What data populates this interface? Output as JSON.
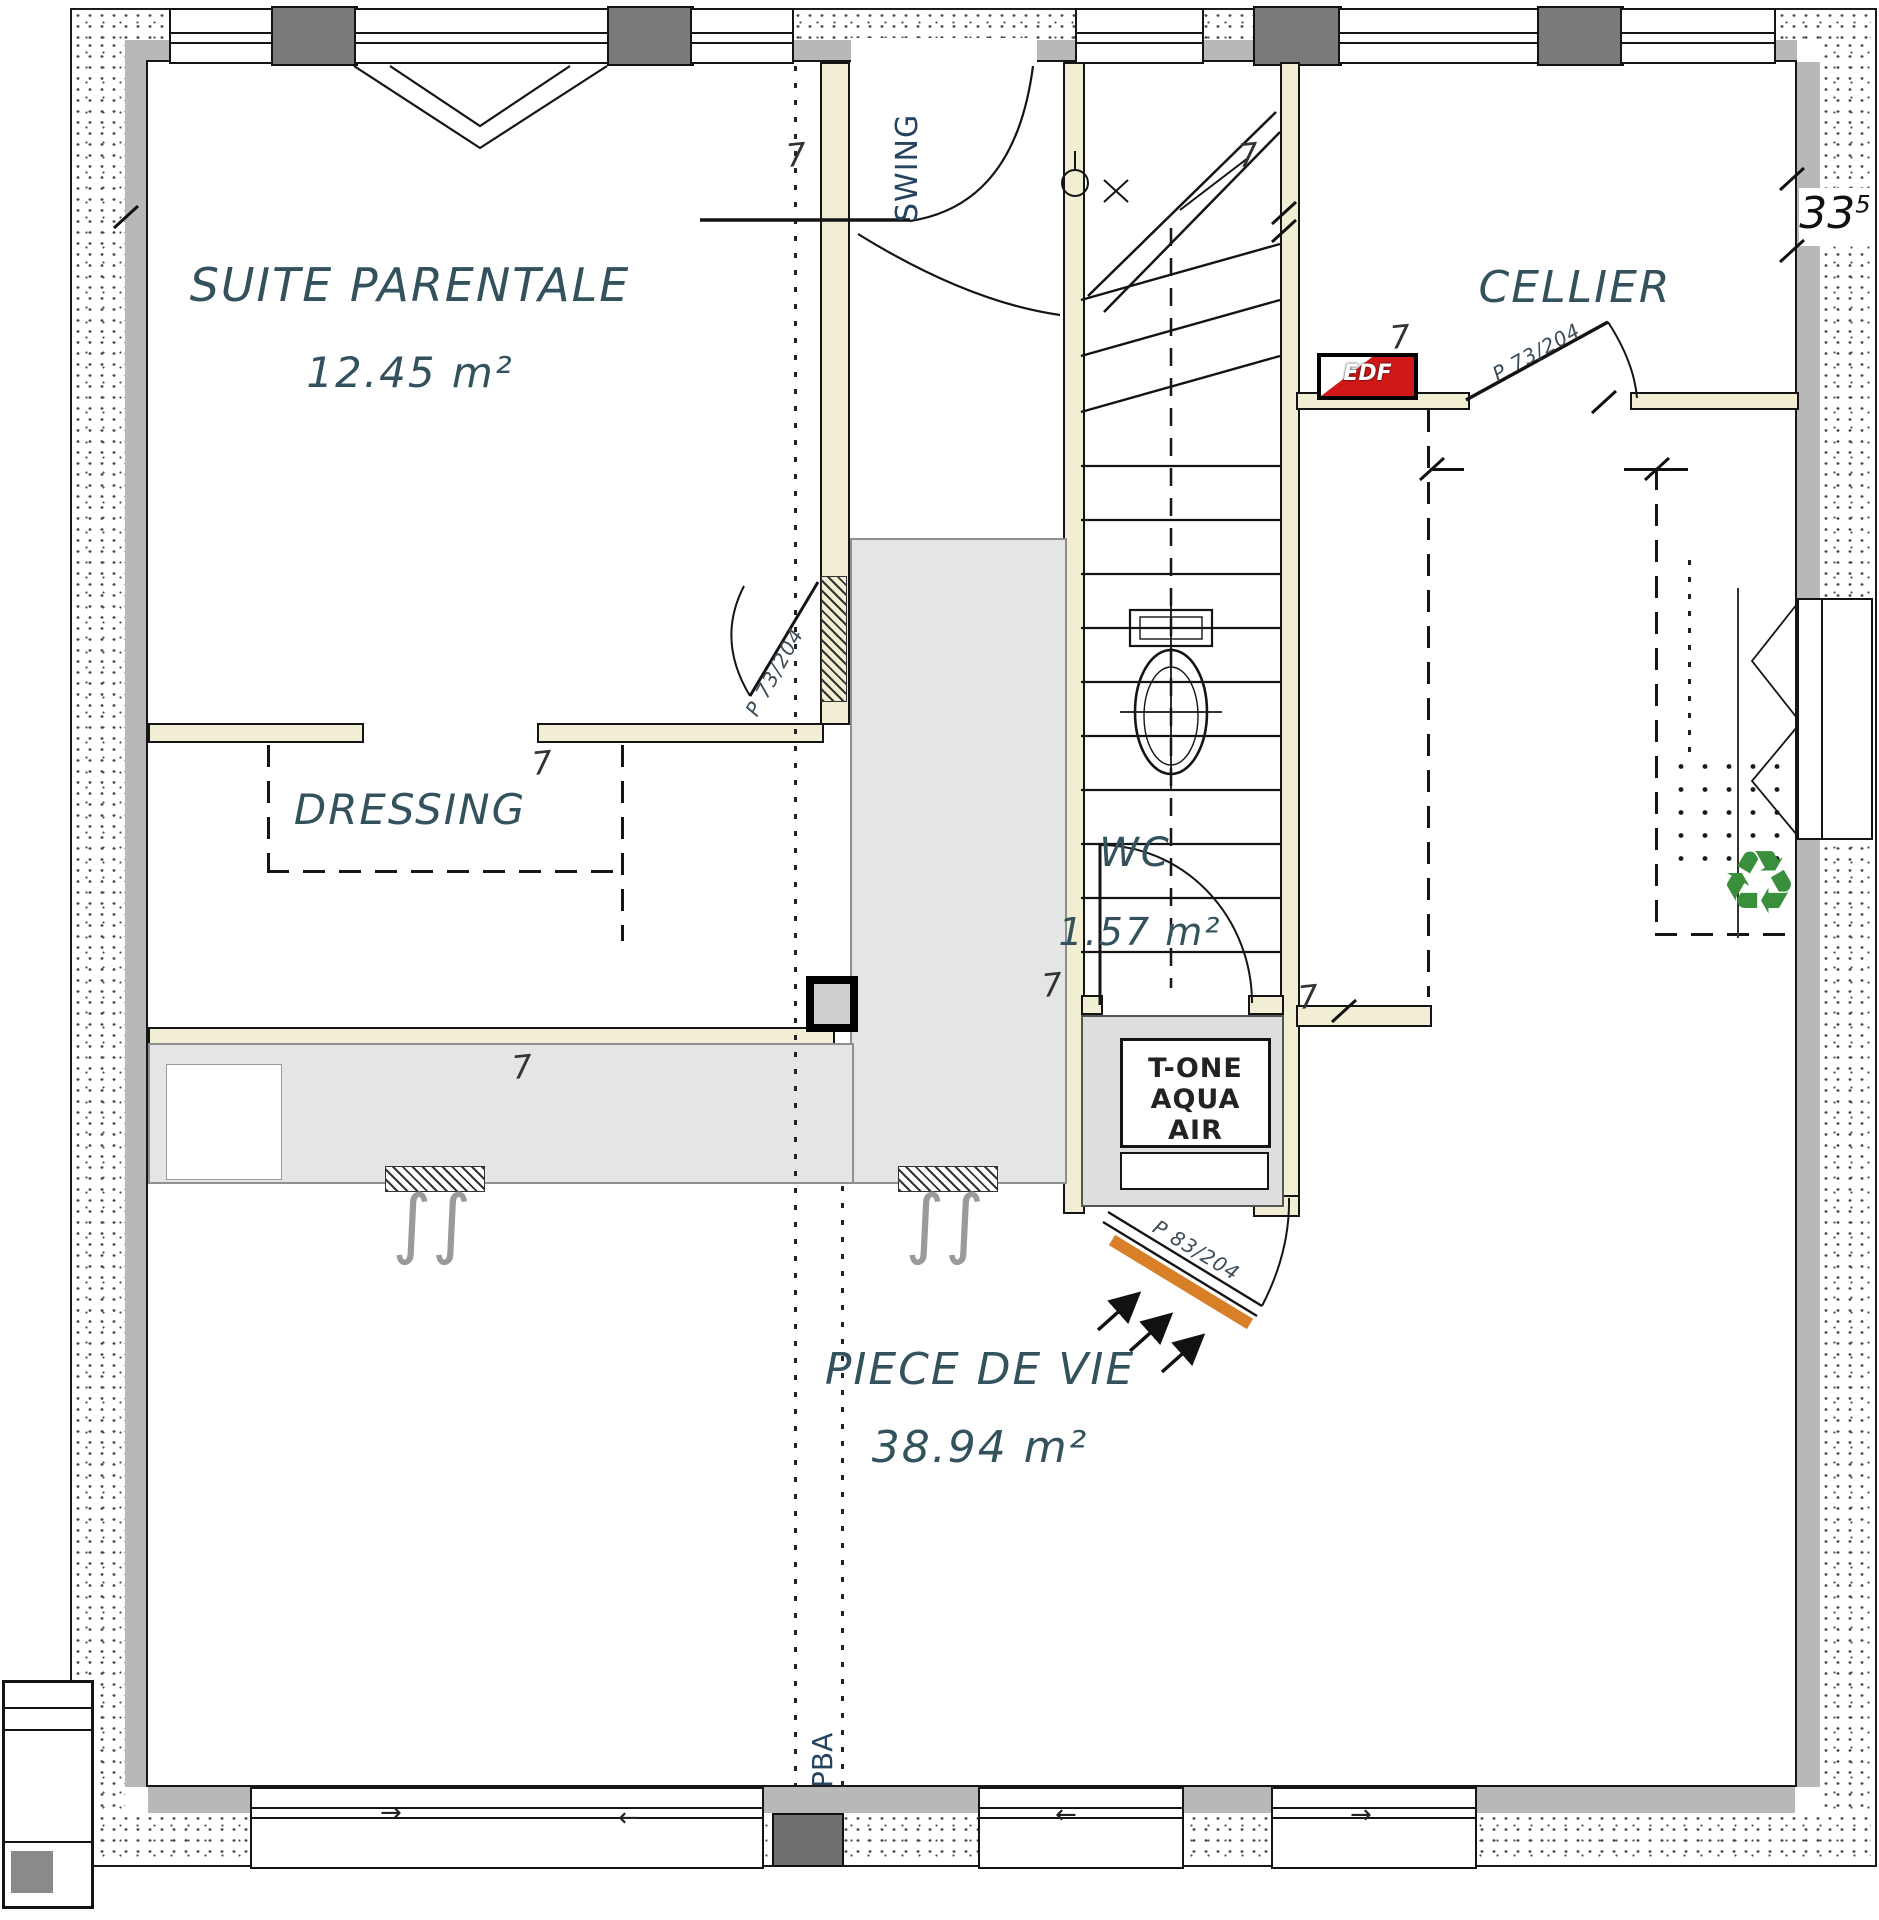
{
  "rooms": {
    "suite": {
      "name": "SUITE PARENTALE",
      "area": "12.45 m²"
    },
    "dressing": {
      "name": "DRESSING"
    },
    "cellier": {
      "name": "CELLIER"
    },
    "wc": {
      "name": "WC",
      "area": "1.57 m²"
    },
    "piece_de_vie": {
      "name": "PIECE DE VIE",
      "area": "38.94 m²"
    }
  },
  "doors": {
    "suite_door": "P 73/204",
    "cellier_door": "P 73/204",
    "entrance_door": "P 83/204"
  },
  "annotations": {
    "swing": "SWING",
    "pba": "PBA",
    "edf": "EDF",
    "hvac_line1": "T-ONE",
    "hvac_line2": "AQUA AIR",
    "dim_33": "33",
    "dim_33_sup": "5",
    "dim_7": "7"
  },
  "icons": {
    "recycle": "♻",
    "slide_left": "←",
    "slide_right": "→",
    "radiator": "∫∫"
  },
  "colors": {
    "edf_red": "#d01818",
    "door_orange": "#d97f28",
    "recycle_green": "#3a8f3c",
    "label_ink": "#33525e",
    "wall_cavity": "#f2eed3"
  }
}
